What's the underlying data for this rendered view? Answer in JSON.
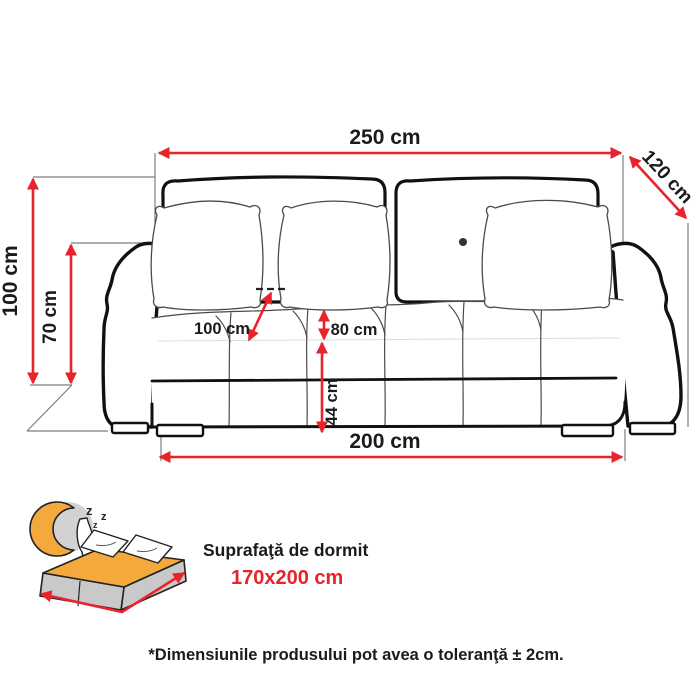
{
  "dimension_labels": {
    "total_width": "250 cm",
    "depth": "120 cm",
    "total_height": "100 cm",
    "arm_height": "70 cm",
    "diag_inner": "100 cm",
    "seat_depth": "80 cm",
    "seat_height": "44 cm",
    "base_width": "200 cm"
  },
  "sleeping_area": {
    "label": "Suprafaţă de dormit",
    "size": "170x200 cm",
    "zzz": [
      "z",
      "z",
      "z"
    ]
  },
  "footnote": "*Dimensiunile produsului pot avea o toleranţă ± 2cm.",
  "colors": {
    "dimension_red": "#e8232b",
    "line_black": "#111111",
    "mattress_orange": "#f3a93c",
    "icon_gray": "#c9c9c9"
  }
}
